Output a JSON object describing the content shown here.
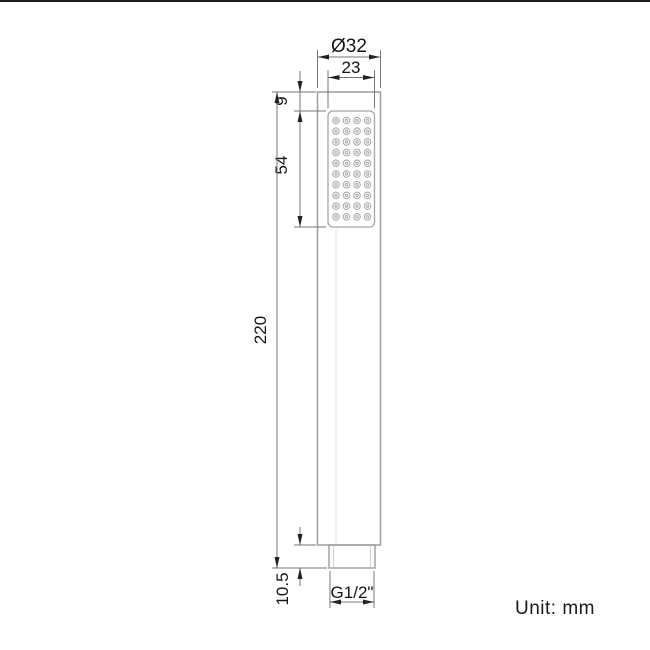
{
  "title": "Handheld shower wand technical drawing",
  "unit_note": "Unit: mm",
  "dimensions": {
    "diameter_top": "Ø32",
    "face_width": "23",
    "face_offset_top": "9",
    "face_height": "54",
    "overall_height": "220",
    "connector_height": "10.5",
    "thread_label": "G1/2\""
  },
  "drawing": {
    "nozzle_grid": {
      "rows": 10,
      "cols": 4
    },
    "colors": {
      "outline": "#9e9e9e",
      "nozzle": "#a6a6a6",
      "dimension_line": "#767676",
      "arrow": "#222222",
      "text": "#141414",
      "background": "#ffffff"
    }
  }
}
